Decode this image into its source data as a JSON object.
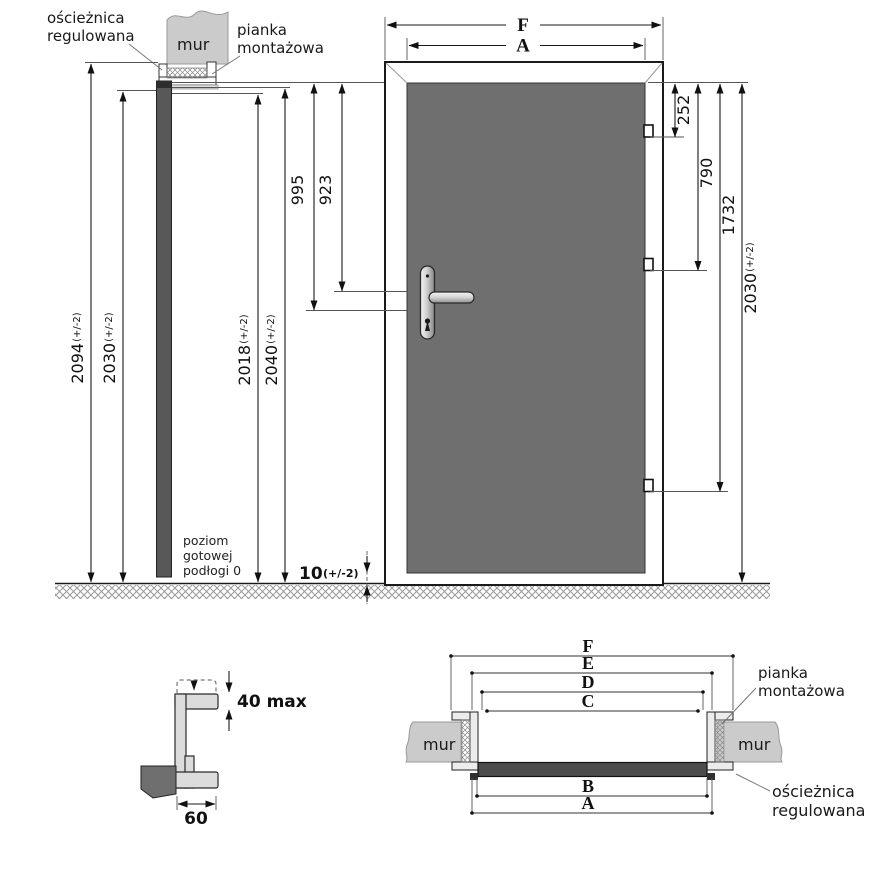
{
  "labels": {
    "frame1": "ościeżnica",
    "frame2": "regulowana",
    "foam1": "pianka",
    "foam2": "montażowa",
    "wall": "mur",
    "floor1": "poziom",
    "floor2": "gotowej",
    "floor3": "podłogi 0"
  },
  "side_view": {
    "d2094": {
      "v": "2094",
      "t": "(+/-2)"
    },
    "d2030": {
      "v": "2030",
      "t": "(+/-2)"
    },
    "d2018": {
      "v": "2018",
      "t": "(+/-2)"
    },
    "d2040": {
      "v": "2040",
      "t": "(+/-2)"
    }
  },
  "front_view": {
    "dF": "F",
    "dA": "A",
    "d995": "995",
    "d923": "923",
    "d252": "252",
    "d790": "790",
    "d1732": "1732",
    "d2030": {
      "v": "2030",
      "t": "(+/-2)"
    },
    "gap": {
      "v": "10",
      "t": "(+/-2)"
    }
  },
  "detail": {
    "d40": "40 max",
    "d60": "60"
  },
  "plan_view": {
    "dims": [
      "F",
      "E",
      "D",
      "C",
      "B",
      "A"
    ]
  }
}
